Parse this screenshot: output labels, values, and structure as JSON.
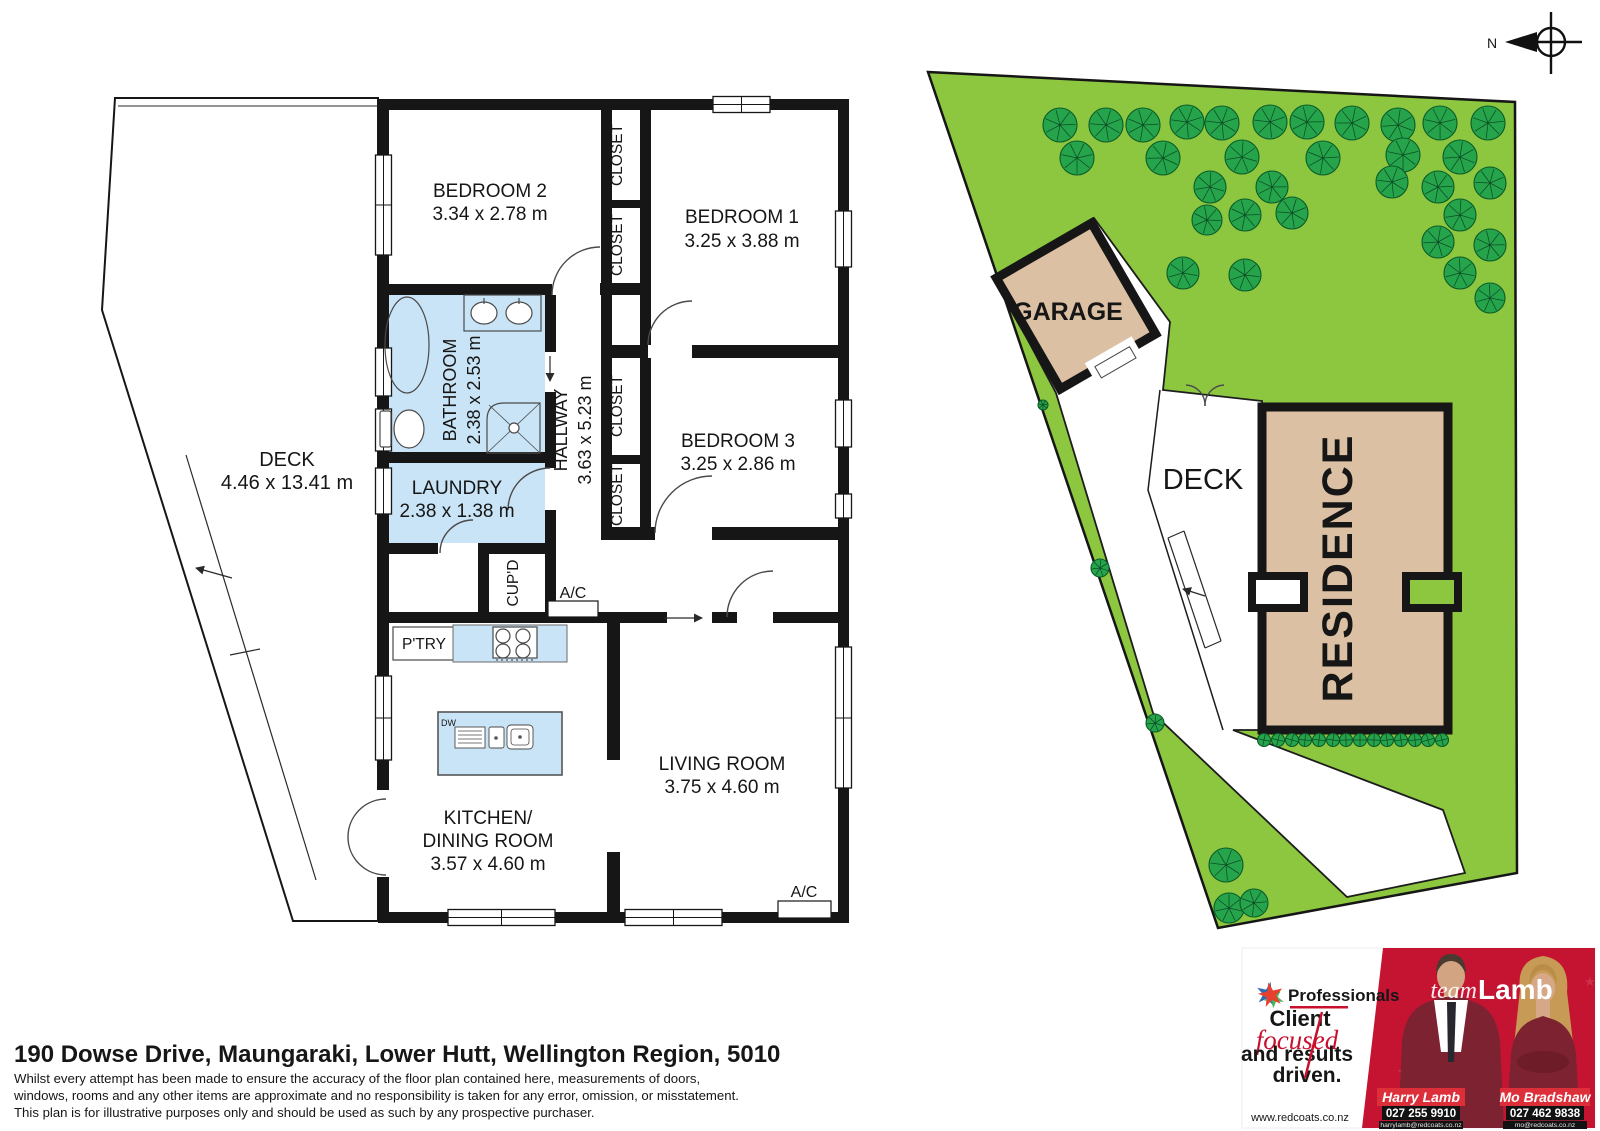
{
  "title_block": {
    "address": "190 Dowse Drive, Maungaraki, Lower Hutt, Wellington Region, 5010",
    "disclaimer": [
      "Whilst every attempt has been made to ensure the accuracy of the floor plan contained here, measurements of doors,",
      "windows, rooms and any other items are approximate and no responsibility is taken for any error, omission, or misstatement.",
      "This plan is for illustrative purposes only and should be used as such by any prospective purchaser."
    ]
  },
  "floor_plan": {
    "rooms": {
      "bedroom2": {
        "name": "BEDROOM 2",
        "dims": "3.34 x 2.78 m"
      },
      "bedroom1": {
        "name": "BEDROOM 1",
        "dims": "3.25 x 3.88 m"
      },
      "bedroom3": {
        "name": "BEDROOM 3",
        "dims": "3.25 x 2.86 m"
      },
      "bathroom": {
        "name": "BATHROOM",
        "dims": "2.38 x 2.53 m"
      },
      "hallway": {
        "name": "HALLWAY",
        "dims": "3.63 x 5.23 m"
      },
      "laundry": {
        "name": "LAUNDRY",
        "dims": "2.38 x 1.38 m"
      },
      "kitchen": {
        "name": "KITCHEN/",
        "name2": "DINING ROOM",
        "dims": "3.57 x 4.60 m"
      },
      "living": {
        "name": "LIVING ROOM",
        "dims": "3.75 x 4.60 m"
      },
      "deck": {
        "name": "DECK",
        "dims": "4.46 x 13.41 m"
      }
    },
    "labels": {
      "closet": "CLOSET",
      "cupd": "CUP'D",
      "ptry": "P'TRY",
      "ac": "A/C",
      "dw": "DW"
    }
  },
  "site_plan": {
    "labels": {
      "garage": "GARAGE",
      "deck": "DECK",
      "residence": "RESIDENCE",
      "compass_north": "N"
    },
    "colors": {
      "lawn": "#8dc63f",
      "tree": "#26a44c",
      "building": "#dcc0a3",
      "wall": "#161616",
      "wet_area": "#c9e4f6"
    },
    "trees": [
      [
        1060,
        125,
        17
      ],
      [
        1106,
        125,
        17
      ],
      [
        1143,
        125,
        17
      ],
      [
        1187,
        122,
        17
      ],
      [
        1222,
        123,
        17
      ],
      [
        1270,
        122,
        17
      ],
      [
        1307,
        122,
        17
      ],
      [
        1352,
        123,
        17
      ],
      [
        1398,
        125,
        17
      ],
      [
        1440,
        123,
        17
      ],
      [
        1488,
        123,
        17
      ],
      [
        1077,
        158,
        17
      ],
      [
        1163,
        158,
        17
      ],
      [
        1242,
        157,
        17
      ],
      [
        1323,
        158,
        17
      ],
      [
        1403,
        155,
        17
      ],
      [
        1460,
        157,
        17
      ],
      [
        1210,
        187,
        16
      ],
      [
        1272,
        187,
        16
      ],
      [
        1392,
        182,
        16
      ],
      [
        1438,
        187,
        16
      ],
      [
        1490,
        183,
        16
      ],
      [
        1207,
        220,
        15
      ],
      [
        1245,
        215,
        16
      ],
      [
        1292,
        213,
        16
      ],
      [
        1460,
        215,
        16
      ],
      [
        1438,
        242,
        16
      ],
      [
        1490,
        245,
        16
      ],
      [
        1183,
        273,
        16
      ],
      [
        1245,
        275,
        16
      ],
      [
        1460,
        273,
        16
      ],
      [
        1490,
        298,
        15
      ],
      [
        1100,
        568,
        9
      ],
      [
        1155,
        723,
        9
      ],
      [
        1043,
        405,
        5
      ],
      [
        1226,
        865,
        17
      ],
      [
        1229,
        908,
        15
      ],
      [
        1254,
        903,
        14
      ]
    ],
    "bushes": [
      [
        1264,
        740
      ],
      [
        1278,
        740
      ],
      [
        1292,
        740
      ],
      [
        1305,
        740
      ],
      [
        1319,
        740
      ],
      [
        1333,
        740
      ],
      [
        1346,
        740
      ],
      [
        1360,
        740
      ],
      [
        1374,
        740
      ],
      [
        1387,
        740
      ],
      [
        1401,
        740
      ],
      [
        1415,
        740
      ],
      [
        1428,
        740
      ],
      [
        1442,
        740
      ]
    ]
  },
  "ad": {
    "brand": "Professionals",
    "slogan": {
      "line1": "Client",
      "line2": "focused",
      "line3": "and results",
      "line4": "driven."
    },
    "website": "www.redcoats.co.nz",
    "team": {
      "script": "team",
      "name": "Lamb"
    },
    "agents": [
      {
        "name": "Harry Lamb",
        "phone": "027 255 9910",
        "email": "harrylamb@redcoats.co.nz"
      },
      {
        "name": "Mo Bradshaw",
        "phone": "027 462 9838",
        "email": "mo@redcoats.co.nz"
      }
    ]
  }
}
